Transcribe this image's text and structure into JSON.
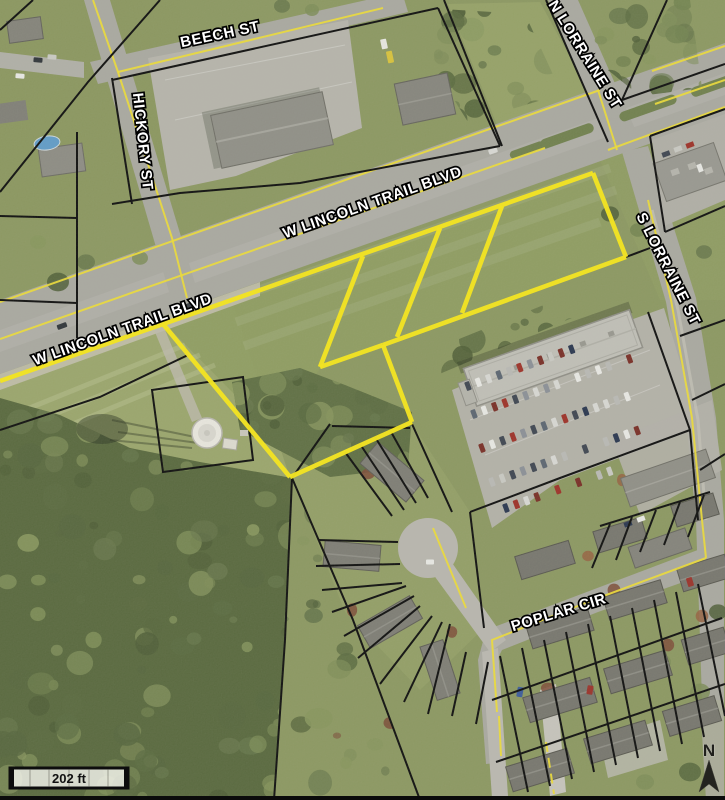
{
  "map": {
    "type": "aerial-parcel-map",
    "street_labels": {
      "beech": "BEECH ST",
      "hickory": "HICKORY ST",
      "n_lorraine": "N LORRAINE ST",
      "lincoln_upper": "W LINCOLN TRAIL BLVD",
      "lincoln_lower": "W LINCOLN TRAIL BLVD",
      "s_lorraine": "S LORRAINE ST",
      "poplar": "POPLAR CIR"
    },
    "scale_bar": {
      "label": "202 ft"
    },
    "north_arrow": {
      "label": "N"
    },
    "highlight_color": "#f7e618",
    "parcel_line_color": "#000000"
  }
}
